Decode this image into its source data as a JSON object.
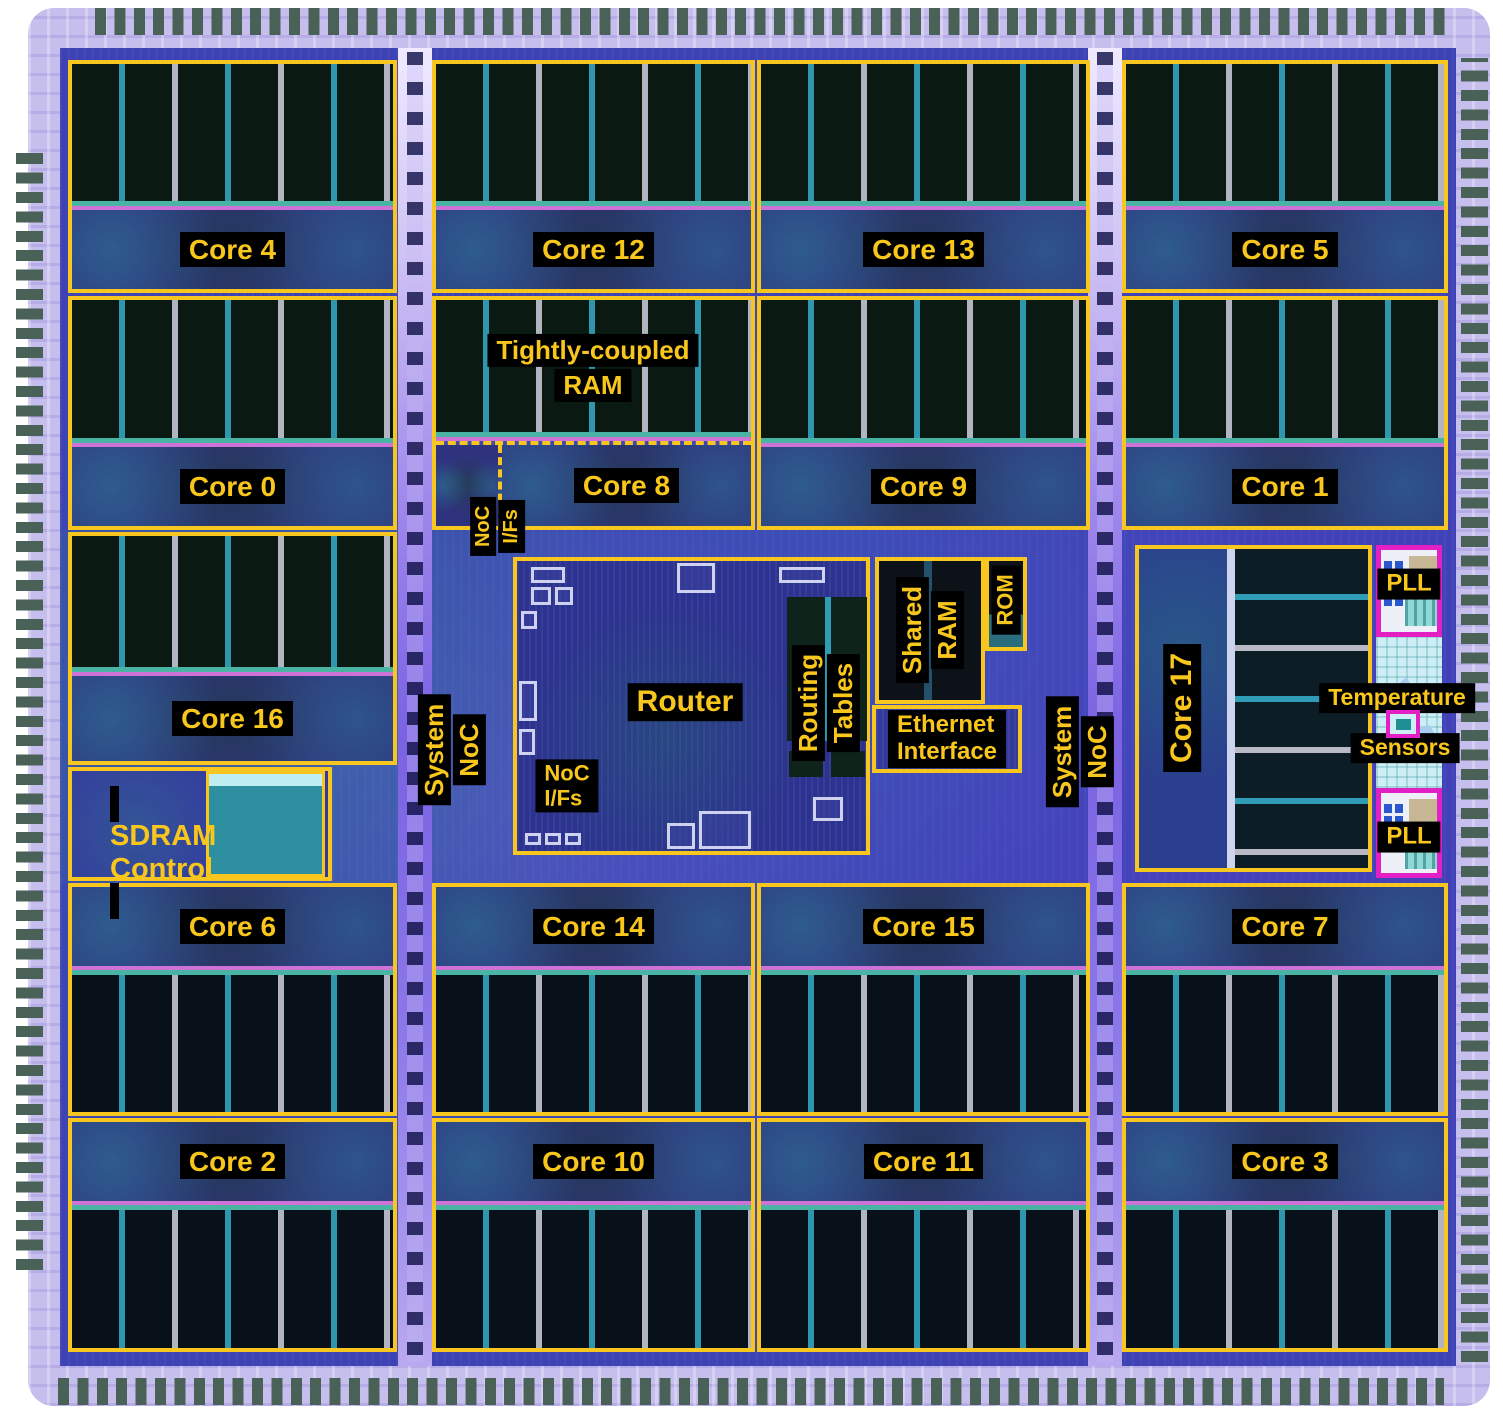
{
  "cores": [
    "Core 0",
    "Core 1",
    "Core 2",
    "Core 3",
    "Core 4",
    "Core 5",
    "Core 6",
    "Core 7",
    "Core 8",
    "Core 9",
    "Core 10",
    "Core 11",
    "Core 12",
    "Core 13",
    "Core 14",
    "Core 15",
    "Core 16",
    "Core 17"
  ],
  "labels": {
    "tcm": {
      "l1": "Tightly-coupled",
      "l2": "RAM"
    },
    "noc_ifs": {
      "l1": "NoC",
      "l2": "I/Fs"
    },
    "router": "Router",
    "router_noc_ifs": {
      "l1": "NoC",
      "l2": "I/Fs"
    },
    "routing_tables": {
      "l1": "Routing",
      "l2": "Tables"
    },
    "shared_ram": {
      "l1": "Shared",
      "l2": "RAM"
    },
    "rom": "ROM",
    "ethernet": {
      "l1": "Ethernet",
      "l2": "Interface"
    },
    "system_noc": {
      "l1": "System",
      "l2": "NoC"
    },
    "sdram": {
      "l1": "SDRAM",
      "l2": "Control"
    },
    "pll": "PLL",
    "temperature": "Temperature",
    "sensors": "Sensors"
  },
  "colors": {
    "region_outline": "#f7c71f",
    "annotation_bg": "#000000",
    "annotation_text": "#f9c71c",
    "pll_outline": "#e320c6",
    "die_fabric": "#3d42b4",
    "pad": "#4a6157",
    "pad_ring": "#c6bfee"
  }
}
